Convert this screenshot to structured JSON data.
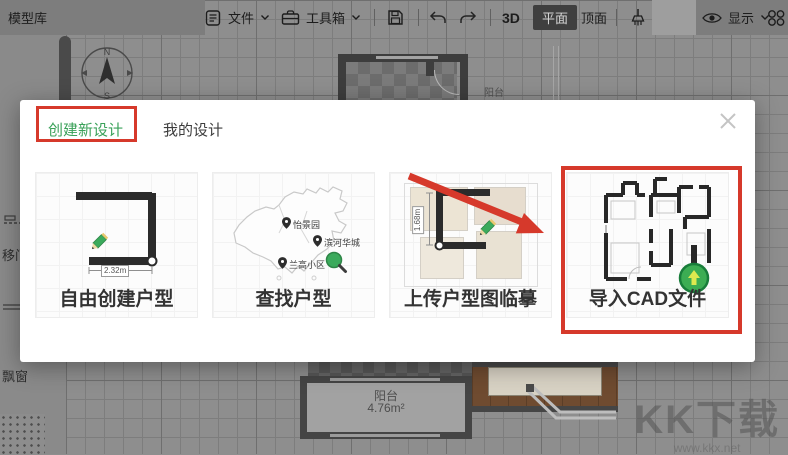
{
  "toolbar": {
    "model_library_label": "模型库",
    "file_label": "文件",
    "toolbox_label": "工具箱",
    "view_3d_label": "3D",
    "view_plan_label": "平面",
    "view_top_label": "顶面",
    "display_label": "显示"
  },
  "left_panel": {
    "items": [
      {
        "label": "移门"
      },
      {
        "label": "飘窗"
      }
    ]
  },
  "canvas": {
    "compass": {
      "north": "N",
      "south": "S"
    },
    "rooms": [
      {
        "name": "阳台"
      },
      {
        "name": "阳台",
        "area": "4.76m²"
      }
    ]
  },
  "modal": {
    "tabs": [
      {
        "label": "创建新设计"
      },
      {
        "label": "我的设计"
      }
    ],
    "cards": [
      {
        "title": "自由创建户型",
        "dimension": "2.32m"
      },
      {
        "title": "查找户型",
        "pins": [
          "怡景园",
          "滨河华城",
          "兰高小区"
        ]
      },
      {
        "title": "上传户型图临摹",
        "dimension": "1.68m"
      },
      {
        "title": "导入CAD文件"
      }
    ]
  },
  "watermark": {
    "title": "KK下载",
    "url": "www.kkx.net"
  },
  "colors": {
    "accent_green": "#3AA159",
    "annotation_red": "#D6392B"
  }
}
